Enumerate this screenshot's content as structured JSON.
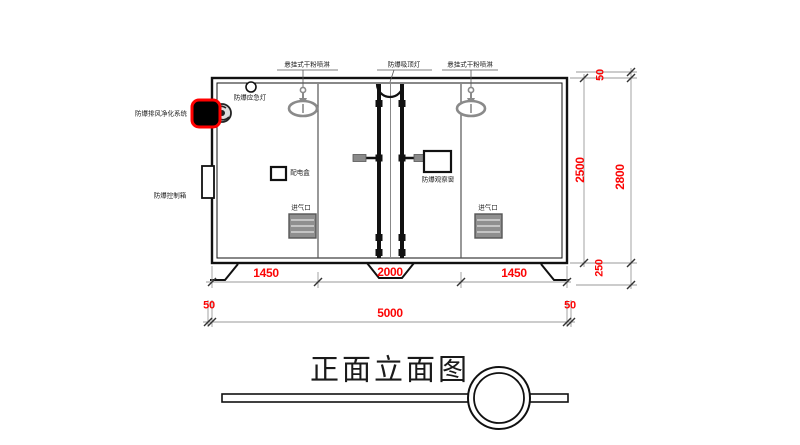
{
  "title": "正面立面图",
  "labels": {
    "sprinkler_left": "悬挂式干粉喷淋",
    "ceiling_lamp": "防爆吸顶灯",
    "sprinkler_right": "悬挂式干粉喷淋",
    "emergency_lamp": "防爆应急灯",
    "exhaust_purifier": "防爆排风净化系统",
    "control_box": "防爆控制箱",
    "power_box": "配电盒",
    "observation_window": "防爆观察窗",
    "air_inlet_left": "进气口",
    "air_inlet_right": "进气口"
  },
  "dimensions": {
    "bottom_row1": [
      "1450",
      "2000",
      "1450"
    ],
    "bottom_left_offset": "50",
    "bottom_total": "5000",
    "bottom_right_offset": "50",
    "right_body_height": "2500",
    "right_top_offset": "50",
    "right_base_height": "250",
    "right_total_height": "2800"
  },
  "colors": {
    "dimension_text": "#fb0505",
    "highlight_border": "#ff0000",
    "drawing_line": "#1a1a1a",
    "fixture_gray": "#8a8a8a"
  }
}
